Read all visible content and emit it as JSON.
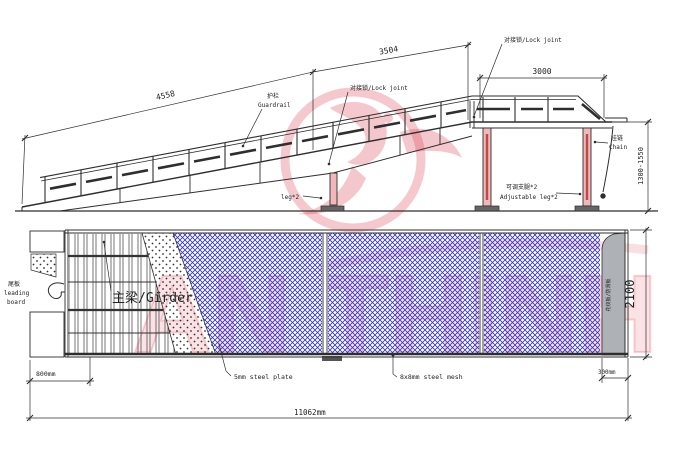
{
  "watermark": {
    "letters": "AN THINH",
    "color": "#d93545"
  },
  "elevation": {
    "dim_4558": "4558",
    "dim_3504": "3504",
    "dim_3000": "3000",
    "dim_height": "1300-1550",
    "guardrail_zh": "护栏",
    "guardrail_en": "Guardrail",
    "lock_joint_mid": "对接锁/Lock joint",
    "lock_joint_top": "对接锁/Lock joint",
    "leg2": "leg*2",
    "adj_leg_zh": "可调支腿*2",
    "adj_leg_en": "Adjustable leg*2",
    "chain_zh": "挂链",
    "chain_en": "Chain"
  },
  "plan": {
    "tail_zh": "尾板",
    "tail_en1": "leading",
    "tail_en2": "board",
    "girder": "主梁/Girder",
    "plate": "5mm steel plate",
    "mesh": "8x8mm steel mesh",
    "lip": "花纹板/防滑板",
    "dim_800": "800mm",
    "dim_11062": "11062mm",
    "dim_300": "300mm",
    "dim_2100": "2100"
  },
  "colors": {
    "ink": "#2e2e2e",
    "mesh_blue": "#3232c8",
    "leg_pink": "#f0b8b8",
    "lip_gray": "#aeb2b6",
    "watermark_red": "#d93545"
  }
}
